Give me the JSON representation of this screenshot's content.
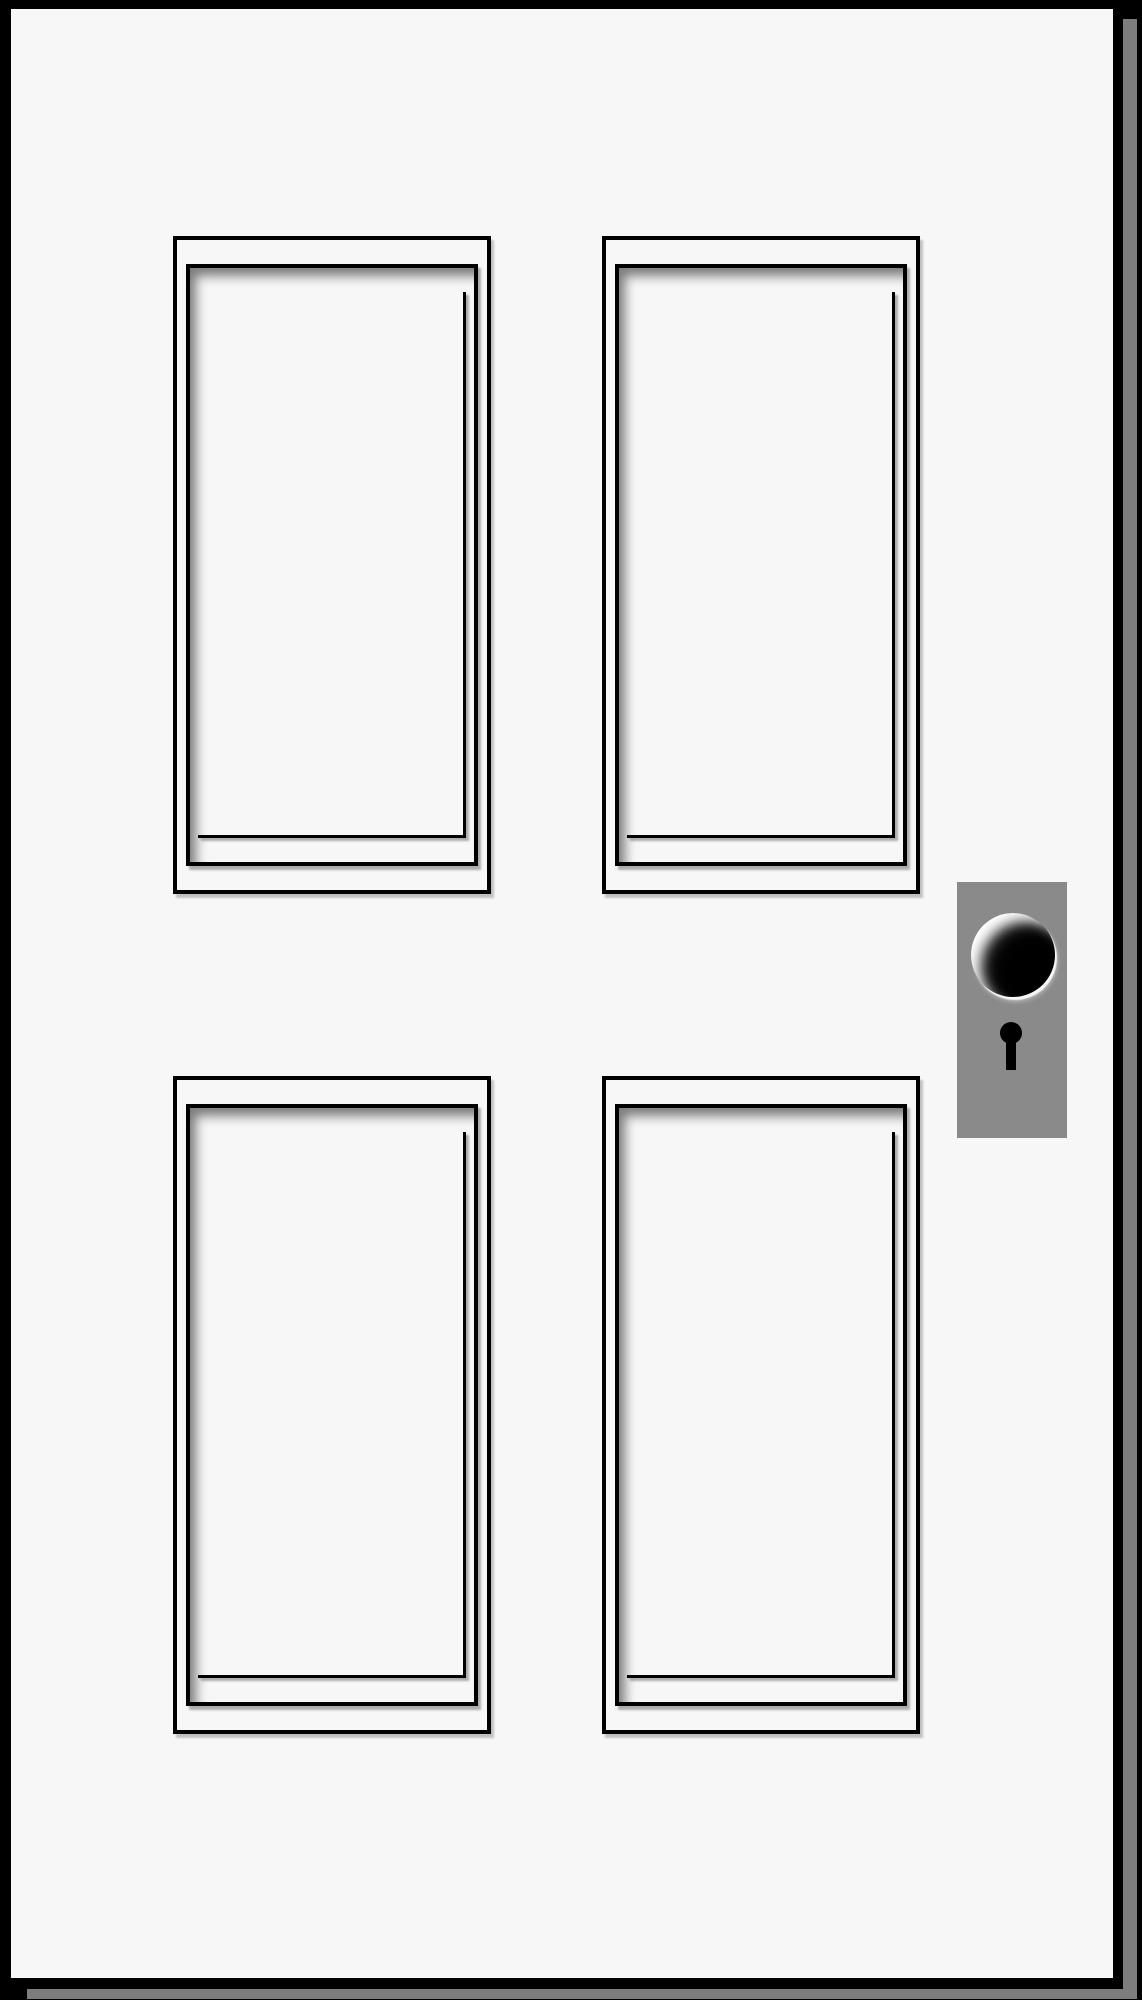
{
  "scene": {
    "kind": "door-illustration",
    "panel_grid": "2x2",
    "panel_count": 4,
    "components": [
      "door-slab",
      "door-jamb-right",
      "door-jamb-bottom",
      "recessed-panel-top-left",
      "recessed-panel-top-right",
      "recessed-panel-bottom-left",
      "recessed-panel-bottom-right",
      "lock-plate",
      "door-knob",
      "keyhole"
    ]
  },
  "colors": {
    "frame-black": "#000000",
    "door-white": "#f7f7f7",
    "jamb-gray": "#7d7d7d",
    "plate-gray": "#8a8a8a",
    "knob-black": "#000000",
    "knob-highlight": "#ffffff",
    "panel-shadow": "rgba(0,0,0,0.5)"
  }
}
